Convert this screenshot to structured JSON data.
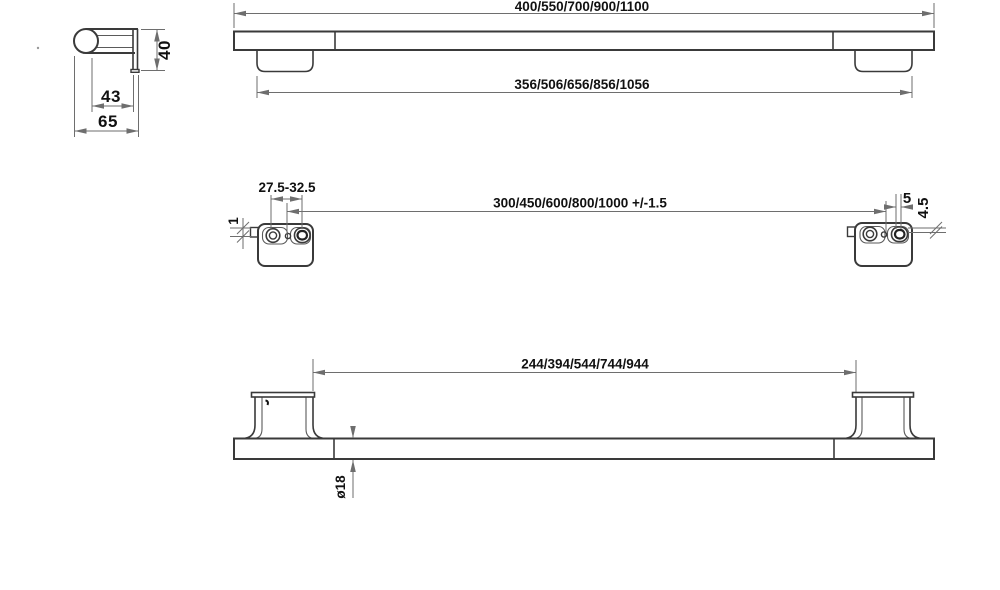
{
  "drawing": {
    "labels": {
      "overall_length": "400/550/700/900/1100",
      "mount_outer_span": "356/506/656/856/1056",
      "bracket_depth_inner": "43",
      "bracket_depth_overall": "65",
      "bracket_height": "40",
      "slot_center_range": "27.5-32.5",
      "plate_lip": "1",
      "screw_centers": "300/450/600/800/1000 +/-1.5",
      "slot_play": "5",
      "slot_height": "4.5",
      "inner_clearance": "244/394/544/744/944",
      "bar_diameter": "ø18"
    },
    "colors": {
      "object_line": "#3a3a3a",
      "dimension_line": "#6e6e6e",
      "text": "#111111",
      "background": "#ffffff"
    }
  }
}
